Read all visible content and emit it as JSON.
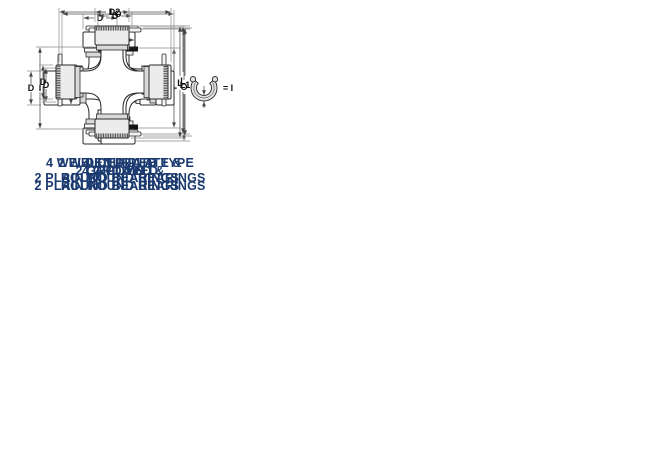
{
  "page": {
    "background": "#ffffff"
  },
  "colors": {
    "caption_text": "#1b3a70",
    "line_art": "#2a2a2a",
    "dimension_line": "#8a8a8a",
    "dimension_text": "#111111",
    "snap_ring_fill": "#e0e0e0",
    "groove_ring_black": "#151515"
  },
  "diagrams": {
    "grooved4": {
      "caption1": "4 GROOVED",
      "caption2": "ROUND BEARINGS",
      "dim_top": "D",
      "dim_left": "D",
      "dim_right": "+",
      "ring_equals": "= I"
    },
    "plain4": {
      "caption1": "4 PLAIN",
      "caption2": "ROUND BEARINGS",
      "dim_top": "D",
      "dim_left": "D",
      "dim_right": "O"
    },
    "grooved2plain2": {
      "caption1": "2 GROOVED &",
      "caption2": "2 PLAIN ROUND BEARINGS",
      "dim_top": "O",
      "dim_cap": "G",
      "dim_left": "I",
      "dim_cup": "P"
    },
    "welded4": {
      "caption1": "4 WELDED PLATE TYPE",
      "caption2": "ROUND BEARINGS",
      "dim_cap_top": "D",
      "dim_cap_left": "D",
      "dim_right": "L"
    },
    "welded2plain2": {
      "caption1": "2 WELDED PLATE &",
      "caption2": "2 PLAIN ROUND BEARINGS",
      "dim_top": "L2",
      "dim_cap_top": "D",
      "dim_cap_left": "D",
      "dim_right": "L1"
    },
    "knurled4": {
      "caption1": "4 KNURLED",
      "caption2": "ROUND BEARINGS",
      "dim_top": "D",
      "dim_left": "D",
      "dim_right": "L"
    }
  }
}
